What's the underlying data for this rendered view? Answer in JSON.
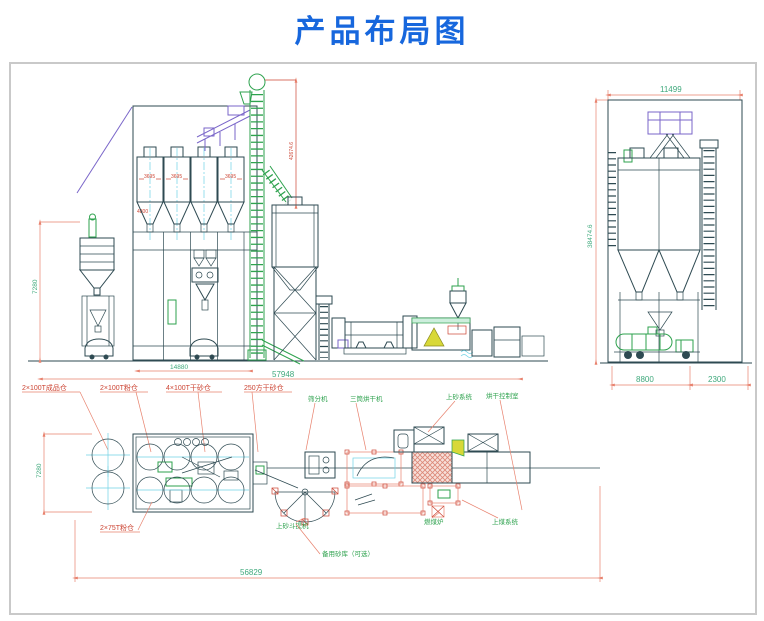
{
  "title": "产品布局图",
  "colors": {
    "title_blue": "#1767dd",
    "structure_line": "#2e4a52",
    "machine_green": "#2ea24e",
    "conveyor_purple": "#7a66c9",
    "centerline_cyan": "#6fd2e4",
    "dimension_line": "#e8826e",
    "dimension_text_green": "#3fa97c",
    "label_red": "#cc4433",
    "dryer_hatch_pink": "#dc8878",
    "furnace_yellow": "#d8d838"
  },
  "elevation": {
    "dim_left_height": "7280",
    "dim_silos_width": "14880",
    "dim_total_width": "57948",
    "dim_elevator_height": "42674.6",
    "silo_level_mark": "3695",
    "note_red": "4800"
  },
  "side_view": {
    "dim_top_width": "11499",
    "dim_height": "38474.6",
    "dim_bottom_left": "8800",
    "dim_bottom_right": "2300"
  },
  "plan": {
    "dim_left_depth": "7280",
    "dim_total_width": "56829"
  },
  "labels": {
    "finished_silo": "2×100T成品仓",
    "powder_silo": "2×100T粉仓",
    "dry_sand_silo": "4×100T干砂仓",
    "big_sand_silo": "250方干砂仓",
    "powder_silo_75": "2×75T粉仓",
    "screen": "筛分机",
    "three_drum_dryer": "三筒烘干机",
    "sand_feed_system": "上砂系统",
    "drying_control_room": "烘干控制室",
    "sand_bucket_elevator": "上砂斗提机",
    "backup_sand_optional": "备用砂库（可选）",
    "coal_furnace": "燃煤炉",
    "coal_feed_system": "上煤系统"
  }
}
